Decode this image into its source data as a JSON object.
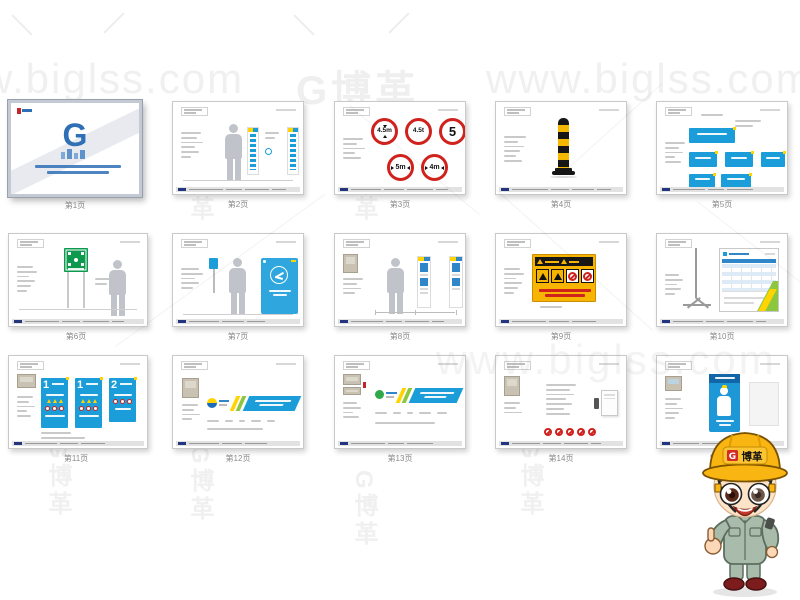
{
  "watermark": {
    "site_full": "www.biglss.com",
    "site_partial": "w.biglss.com",
    "logo_full": "G博革",
    "logo_glyph": "G",
    "logo_text": "博革"
  },
  "cover": {
    "logo_glyph": "G"
  },
  "mascot": {
    "helmet_glyph": "G",
    "helmet_text": "博革"
  },
  "colors": {
    "brand_blue": "#1b9dd9",
    "sign_red": "#d0221d",
    "sign_green": "#0d9a4e",
    "warning_yellow": "#f7b400",
    "helmet_yellow": "#f9b511"
  },
  "gallery": {
    "slides": [
      {
        "caption": "第1页"
      },
      {
        "caption": "第2页"
      },
      {
        "caption": "第3页",
        "signs": [
          "4.5m",
          "4.5t",
          "5",
          "5m",
          "4m"
        ]
      },
      {
        "caption": "第4页"
      },
      {
        "caption": "第5页"
      },
      {
        "caption": "第6页"
      },
      {
        "caption": "第7页"
      },
      {
        "caption": "第8页"
      },
      {
        "caption": "第9页"
      },
      {
        "caption": "第10页"
      },
      {
        "caption": "第11页",
        "poster_numbers": [
          "1",
          "1",
          "2"
        ]
      },
      {
        "caption": "第12页"
      },
      {
        "caption": "第13页"
      },
      {
        "caption": "第14页"
      },
      {
        "caption": "第15页"
      }
    ]
  }
}
